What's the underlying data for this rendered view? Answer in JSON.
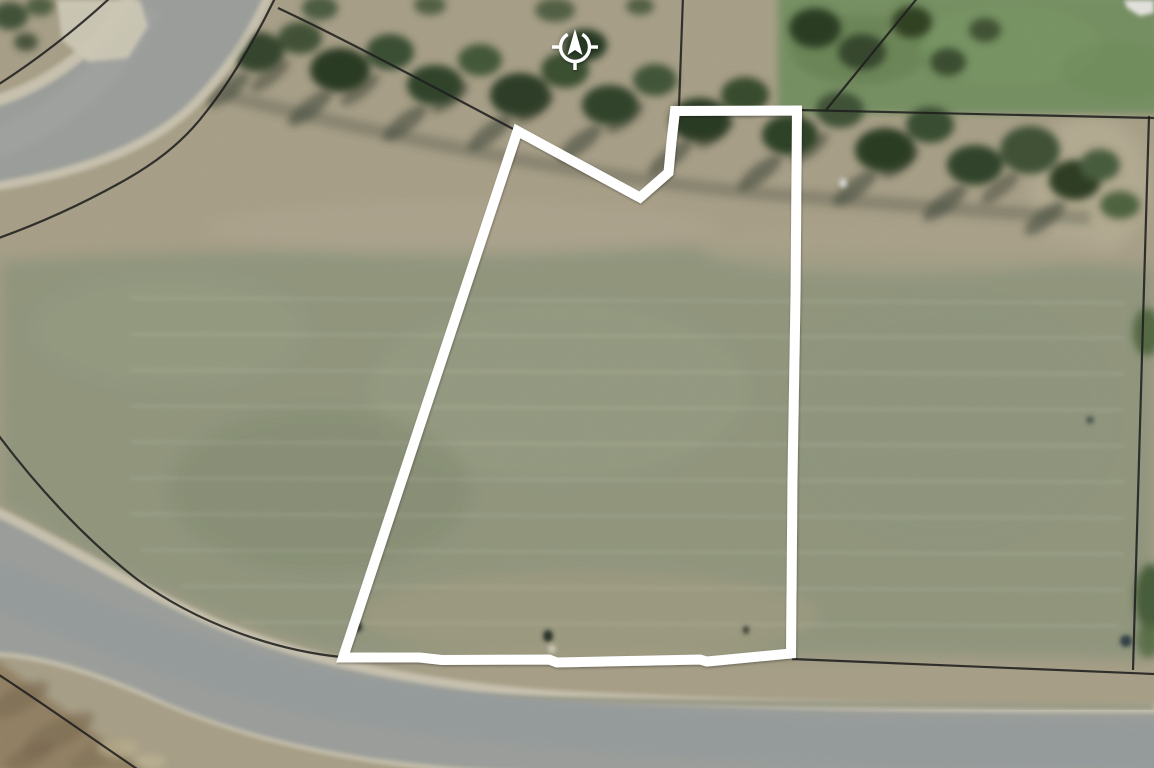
{
  "map": {
    "compass": {
      "transform": "translate(575,47)",
      "color": "#ffffff",
      "ring_d": "M 7.3,-12.6 A 14.5,14.5 0 1 1 -7.3,-12.6",
      "arrow_points": "0,-18 7.5,8 0,3 -7.5,8",
      "tick_west_d": "M -23,0 L -15,0",
      "tick_east_d": "M 15,0 L 23,0",
      "tick_south_d": "M 0,15 L 0,23"
    },
    "parcel_outline": {
      "color": "#ffffff",
      "stroke_width": "10",
      "points": "517.5,131 640,197.5 668.5,172.5 671.5,141.5 675,111 797,110.5 795.5,297 792.5,478 791,653.5 707,661.5 700,659.5 557,662.5 549,659.5 442,660 420,657.5 343,657.5"
    },
    "boundary_lines": {
      "color": "#1f1f1f",
      "stroke_width": "2.2",
      "nw_outer_d": "M -4,86 C 34,62 78,28 112,-4",
      "nw_road_east_d": "M 277,-6 C 256,38 230,82 206,112 C 181,145 151,166 118,184 C 80,205 38,224 -4,239",
      "north_split_west_d": "M 278,8 C 342,38 432,86 517,131",
      "north_split_mid_d": "M 683,-4 L 679,107",
      "ne_diagonal_d": "M 919,-4 L 826,110",
      "north_row_d": "M 797,110 L 1154,118",
      "east_row_d": "M 1149,116 C 1144,300 1137,500 1133,670",
      "south_row_d": "M 792,659 C 910,664 1040,669 1154,674",
      "sw_road_upper_d": "M -4,432 C 36,486 86,540 138,580 C 196,622 272,650 341,657",
      "sw_road_lower_d": "M -4,673 C 44,704 94,740 140,771"
    },
    "roads": {
      "asphalt": "#a6a9a5",
      "curb": "#d9d3c0",
      "northwest": {
        "surface_d": "M -6,108 C 52,90 98,55 134,6 L 140,-10 L 266,-10 C 252,24 228,62 196,96 C 158,136 96,166 -6,182 Z",
        "curb_upper_d": "M -6,104 C 52,86 99,51 136,-8",
        "curb_lower_d": "M 268,-8 C 253,26 229,64 197,98 C 159,138 96,168 -6,184",
        "wash_d": "M -6,144 C 55,122 105,82 148,6"
      },
      "south": {
        "surface_d": "M -6,516 C 60,548 128,590 212,627 C 304,665 424,691 564,700 C 754,710 950,713 1160,713 L 1160,786 C 950,781 700,776 500,770 C 370,764 260,742 170,704 C 108,676 50,654 -6,652 Z",
        "curb_upper_d": "M -6,513 C 62,545 130,588 214,625 C 306,663 426,689 566,698 C 756,708 952,711 1160,711",
        "curb_lower_d": "M -6,649 C 52,652 110,674 172,701 C 262,739 372,762 502,768 C 702,774 952,779 1160,783",
        "wash_d": "M -6,584 C 90,622 190,664 310,692 C 440,718 640,736 860,742 C 960,744 1070,745 1160,745"
      },
      "driveway_points": "57,0 140,0 148,26 128,58 88,62 62,40"
    },
    "palette": {
      "terrain_tan": "#b4ab92",
      "field_olive": "#98a085",
      "tree_green": "#3a4e31",
      "lawn_green": "#7f9a6a",
      "rough_grass": "#9c8a6c",
      "asphalt": "#a6a9a5",
      "curb": "#d9d3c0",
      "parcel_white": "#ffffff",
      "boundary_black": "#1f1f1f"
    }
  }
}
